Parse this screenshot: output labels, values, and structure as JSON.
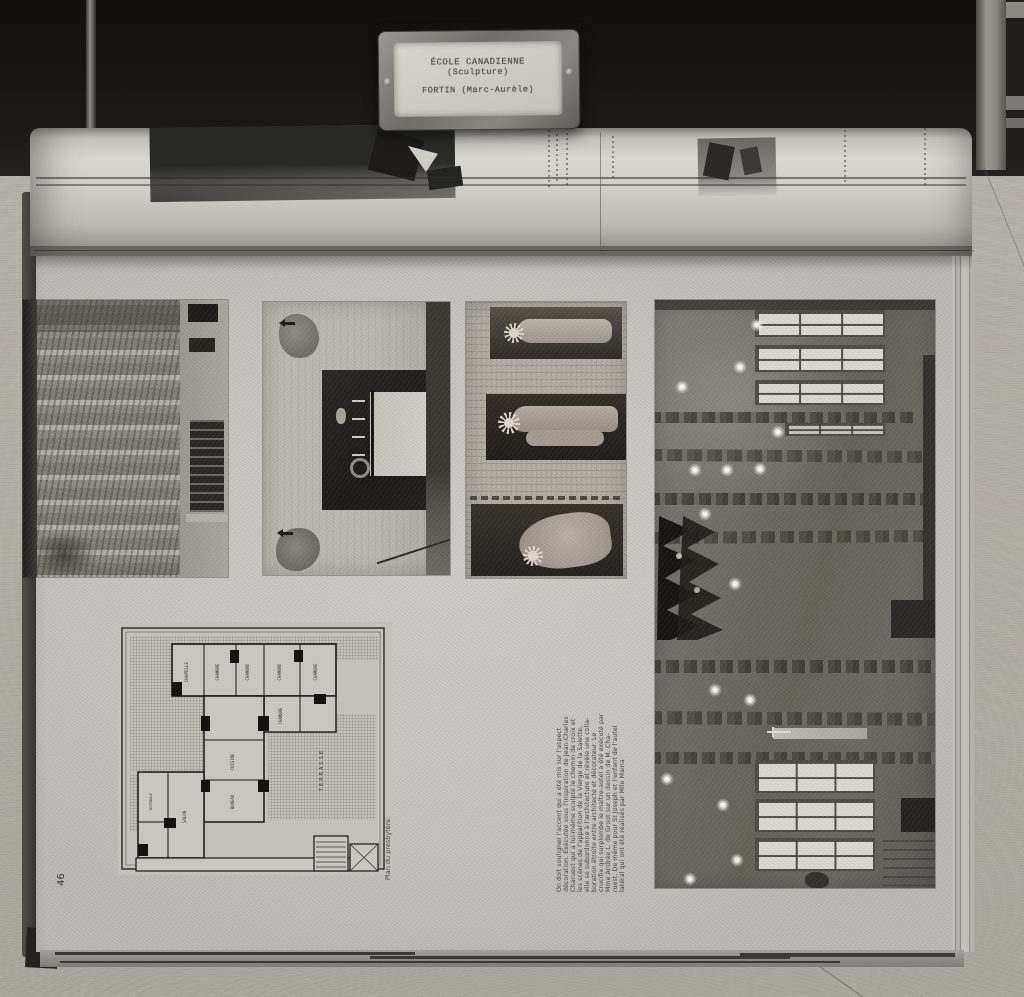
{
  "label_plate": {
    "line1": "ÉCOLE CANADIENNE",
    "line2": "(Sculpture)",
    "line3": "FORTIN (Marc-Aurèle)"
  },
  "page": {
    "number": "46",
    "plan_caption": "Plan du presbytère.",
    "body_lines": [
      "On doit souligner l'accent qui a été mis sur l'aspect",
      "décoration. Exécutée sous l'inspiration de Jean-Charles",
      "Charuest qui a lui-même sculpté le chemin de croix et",
      "les scènes de l'apparition de la Vierge de la Salette,",
      "elle se subordonne à l'architecture et révèle une colla-",
      "boration étroite entre architecte et décorateur. Le",
      "crucifix qui surplombe le maître-autel a été exécuté par",
      "Mme Andrée L. de Groot sur un dessin de M. Cha-",
      "ruest. De même pour St Joseph et l'enfant de l'autel",
      "latéral qui ont été réalisés par Mlle Maina"
    ]
  },
  "plan": {
    "rooms": [
      "CHAPELLE",
      "CHAMBRE",
      "CHAMBRE",
      "CHAMBRE",
      "CHAMBRE",
      "CHAMBRE",
      "CUISINE",
      "BUREAU",
      "SALON",
      "VESTIBULE",
      "TERRASSE"
    ]
  },
  "colors": {
    "paper": "#c6c5c1",
    "wood": "#b3b0a8",
    "dark_background": "#161513",
    "photo_dark": "#2b2824"
  }
}
